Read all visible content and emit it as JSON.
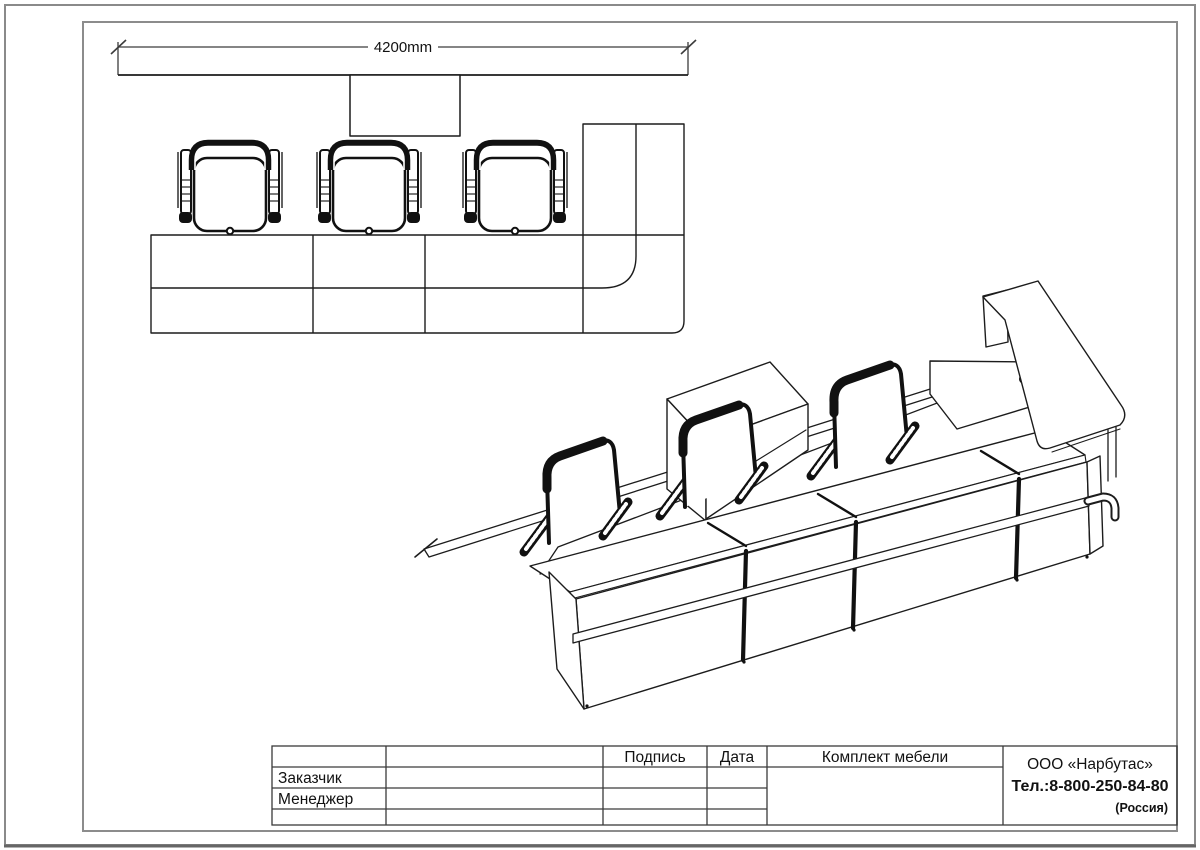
{
  "document": {
    "kind": "furniture-set technical drawing",
    "views": [
      "plan view with dimension",
      "isometric view of reception counter"
    ]
  },
  "colors": {
    "line": "#1c1c1c",
    "frame_gray": "#8c8c8c",
    "outer_border": "#777777",
    "text": "#111111",
    "dimension_text": "#3c3c3c"
  },
  "plan_view": {
    "dimension_label": "4200mm",
    "chair_count": 3
  },
  "iso_view": {
    "description": "reception counter with three chairs, hutch cabinet and corner return desk"
  },
  "title_block": {
    "signature_header": "Подпись",
    "date_header": "Дата",
    "set_header": "Комплект мебели",
    "rows": [
      {
        "label": "Заказчик"
      },
      {
        "label": "Менеджер"
      }
    ],
    "company": {
      "name": "ООО «Нарбутас»",
      "phone": "Тел.:8-800-250-84-80",
      "country": "(Россия)"
    }
  }
}
